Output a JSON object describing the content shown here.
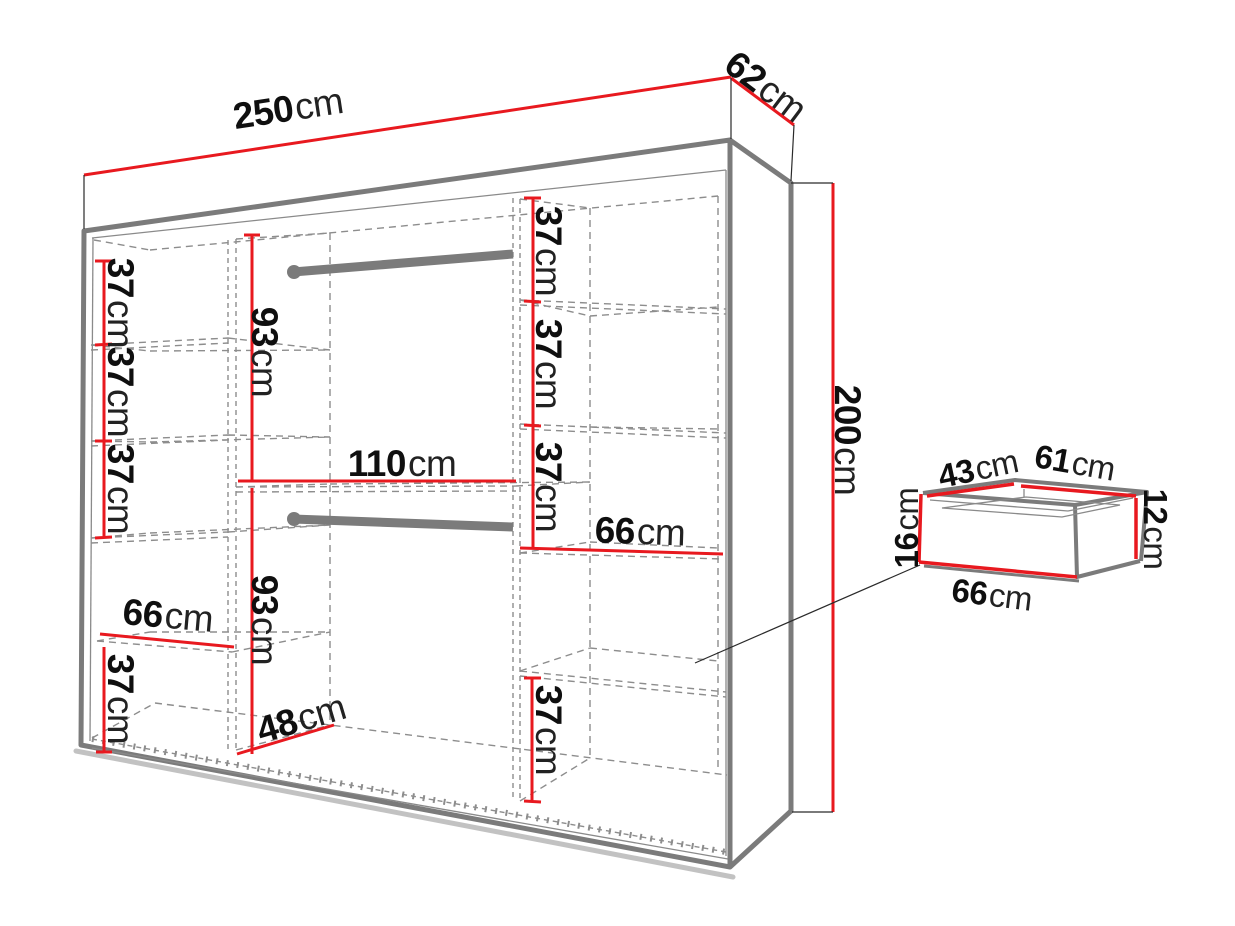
{
  "diagram": {
    "type": "furniture-dimension-diagram",
    "subject": "wardrobe with interior shelf layout and separate drawer detail",
    "unit": "cm",
    "colors": {
      "dimension_line": "#e8191f",
      "outline": "#7b7b7b",
      "dashed_line": "#8d8d8d",
      "label_text": "#141414",
      "background": "#ffffff"
    },
    "overall": {
      "width": {
        "value": "250",
        "unit": "cm"
      },
      "depth": {
        "value": "62",
        "unit": "cm"
      },
      "height": {
        "value": "200",
        "unit": "cm"
      }
    },
    "interior": {
      "left_column": {
        "shelf_1_height": {
          "value": "37",
          "unit": "cm"
        },
        "shelf_2_height": {
          "value": "37",
          "unit": "cm"
        },
        "shelf_3_height": {
          "value": "37",
          "unit": "cm"
        },
        "shelf_width": {
          "value": "66",
          "unit": "cm"
        },
        "bottom_section_height": {
          "value": "37",
          "unit": "cm"
        }
      },
      "middle_column": {
        "upper_hanging_section_height": {
          "value": "93",
          "unit": "cm"
        },
        "width": {
          "value": "110",
          "unit": "cm"
        },
        "lower_hanging_section_height": {
          "value": "93",
          "unit": "cm"
        },
        "floor_depth": {
          "value": "48",
          "unit": "cm"
        }
      },
      "right_column": {
        "shelf_1_height": {
          "value": "37",
          "unit": "cm"
        },
        "shelf_2_height": {
          "value": "37",
          "unit": "cm"
        },
        "shelf_3_height": {
          "value": "37",
          "unit": "cm"
        },
        "shelf_width": {
          "value": "66",
          "unit": "cm"
        },
        "bottom_section_height": {
          "value": "37",
          "unit": "cm"
        }
      }
    },
    "drawer_detail": {
      "inner_depth": {
        "value": "43",
        "unit": "cm"
      },
      "inner_width": {
        "value": "61",
        "unit": "cm"
      },
      "front_height": {
        "value": "16",
        "unit": "cm"
      },
      "inner_height": {
        "value": "12",
        "unit": "cm"
      },
      "outer_width": {
        "value": "66",
        "unit": "cm"
      }
    }
  }
}
